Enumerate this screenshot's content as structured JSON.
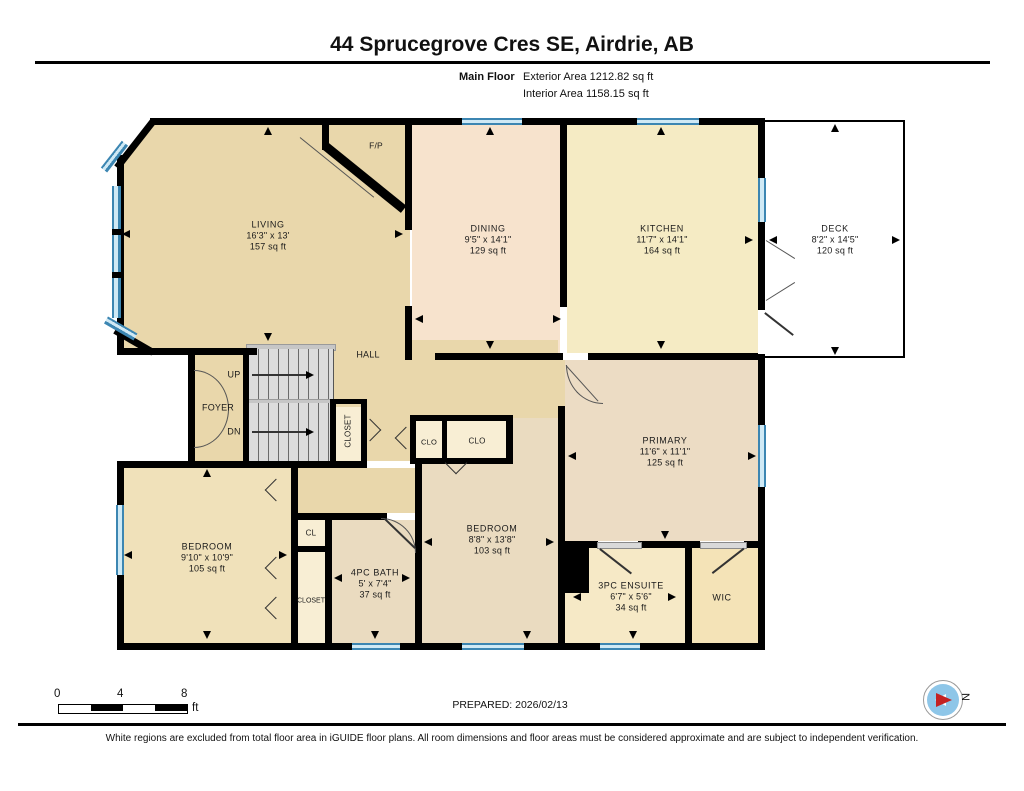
{
  "header": {
    "title": "44 Sprucegrove Cres SE, Airdrie, AB",
    "floor_label": "Main Floor",
    "exterior_area": "Exterior Area 1212.82 sq ft",
    "interior_area": "Interior Area 1158.15 sq ft"
  },
  "rooms": {
    "living": {
      "name": "LIVING",
      "dims": "16'3\" x 13'",
      "area": "157 sq ft"
    },
    "dining": {
      "name": "DINING",
      "dims": "9'5\" x 14'1\"",
      "area": "129 sq ft"
    },
    "kitchen": {
      "name": "KITCHEN",
      "dims": "11'7\" x 14'1\"",
      "area": "164 sq ft"
    },
    "deck": {
      "name": "DECK",
      "dims": "8'2\" x 14'5\"",
      "area": "120 sq ft"
    },
    "primary": {
      "name": "PRIMARY",
      "dims": "11'6\" x 11'1\"",
      "area": "125 sq ft"
    },
    "bedroom_left": {
      "name": "BEDROOM",
      "dims": "9'10\" x 10'9\"",
      "area": "105 sq ft"
    },
    "bedroom_middle": {
      "name": "BEDROOM",
      "dims": "8'8\" x 13'8\"",
      "area": "103 sq ft"
    },
    "bath": {
      "name": "4PC BATH",
      "dims": "5' x 7'4\"",
      "area": "37 sq ft"
    },
    "ensuite": {
      "name": "3PC ENSUITE",
      "dims": "6'7\" x 5'6\"",
      "area": "34 sq ft"
    },
    "wic": {
      "name": "WIC"
    }
  },
  "labels": {
    "hall": "HALL",
    "foyer": "FOYER",
    "up": "UP",
    "down": "DN",
    "stair_closet": "CLOSET",
    "bedroom_closet": "CLOSET",
    "hall_closet_small": "CLO",
    "hall_closet": "CLO",
    "cl": "CL",
    "fireplace": "F/P"
  },
  "scale_bar": {
    "tick_0": "0",
    "tick_4": "4",
    "tick_8": "8",
    "unit": "ft"
  },
  "footer": {
    "prepared": "PREPARED: 2026/02/13",
    "compass_north": "N",
    "disclaimer": "White regions are excluded from total floor area in iGUIDE floor plans. All room dimensions and floor areas must be considered approximate and are subject to independent verification."
  },
  "colors": {
    "wall": "#000000",
    "window_blue": "#3c86b2",
    "living_fill": "#e9d7ab",
    "dining_fill": "#f7e3cd",
    "kitchen_fill": "#f5ebc4",
    "bedroom_fill": "#eadbc0",
    "bedroom_left_fill": "#f0e1ba",
    "closet_fill": "#f8eed4",
    "ensuite_fill": "#f6e9c6",
    "wic_fill": "#f4e3b7",
    "deck_fill": "#ffffff",
    "stair_fill": "#dcdcdc",
    "compass_red": "#c42222",
    "compass_blue": "#8ec6e8"
  }
}
